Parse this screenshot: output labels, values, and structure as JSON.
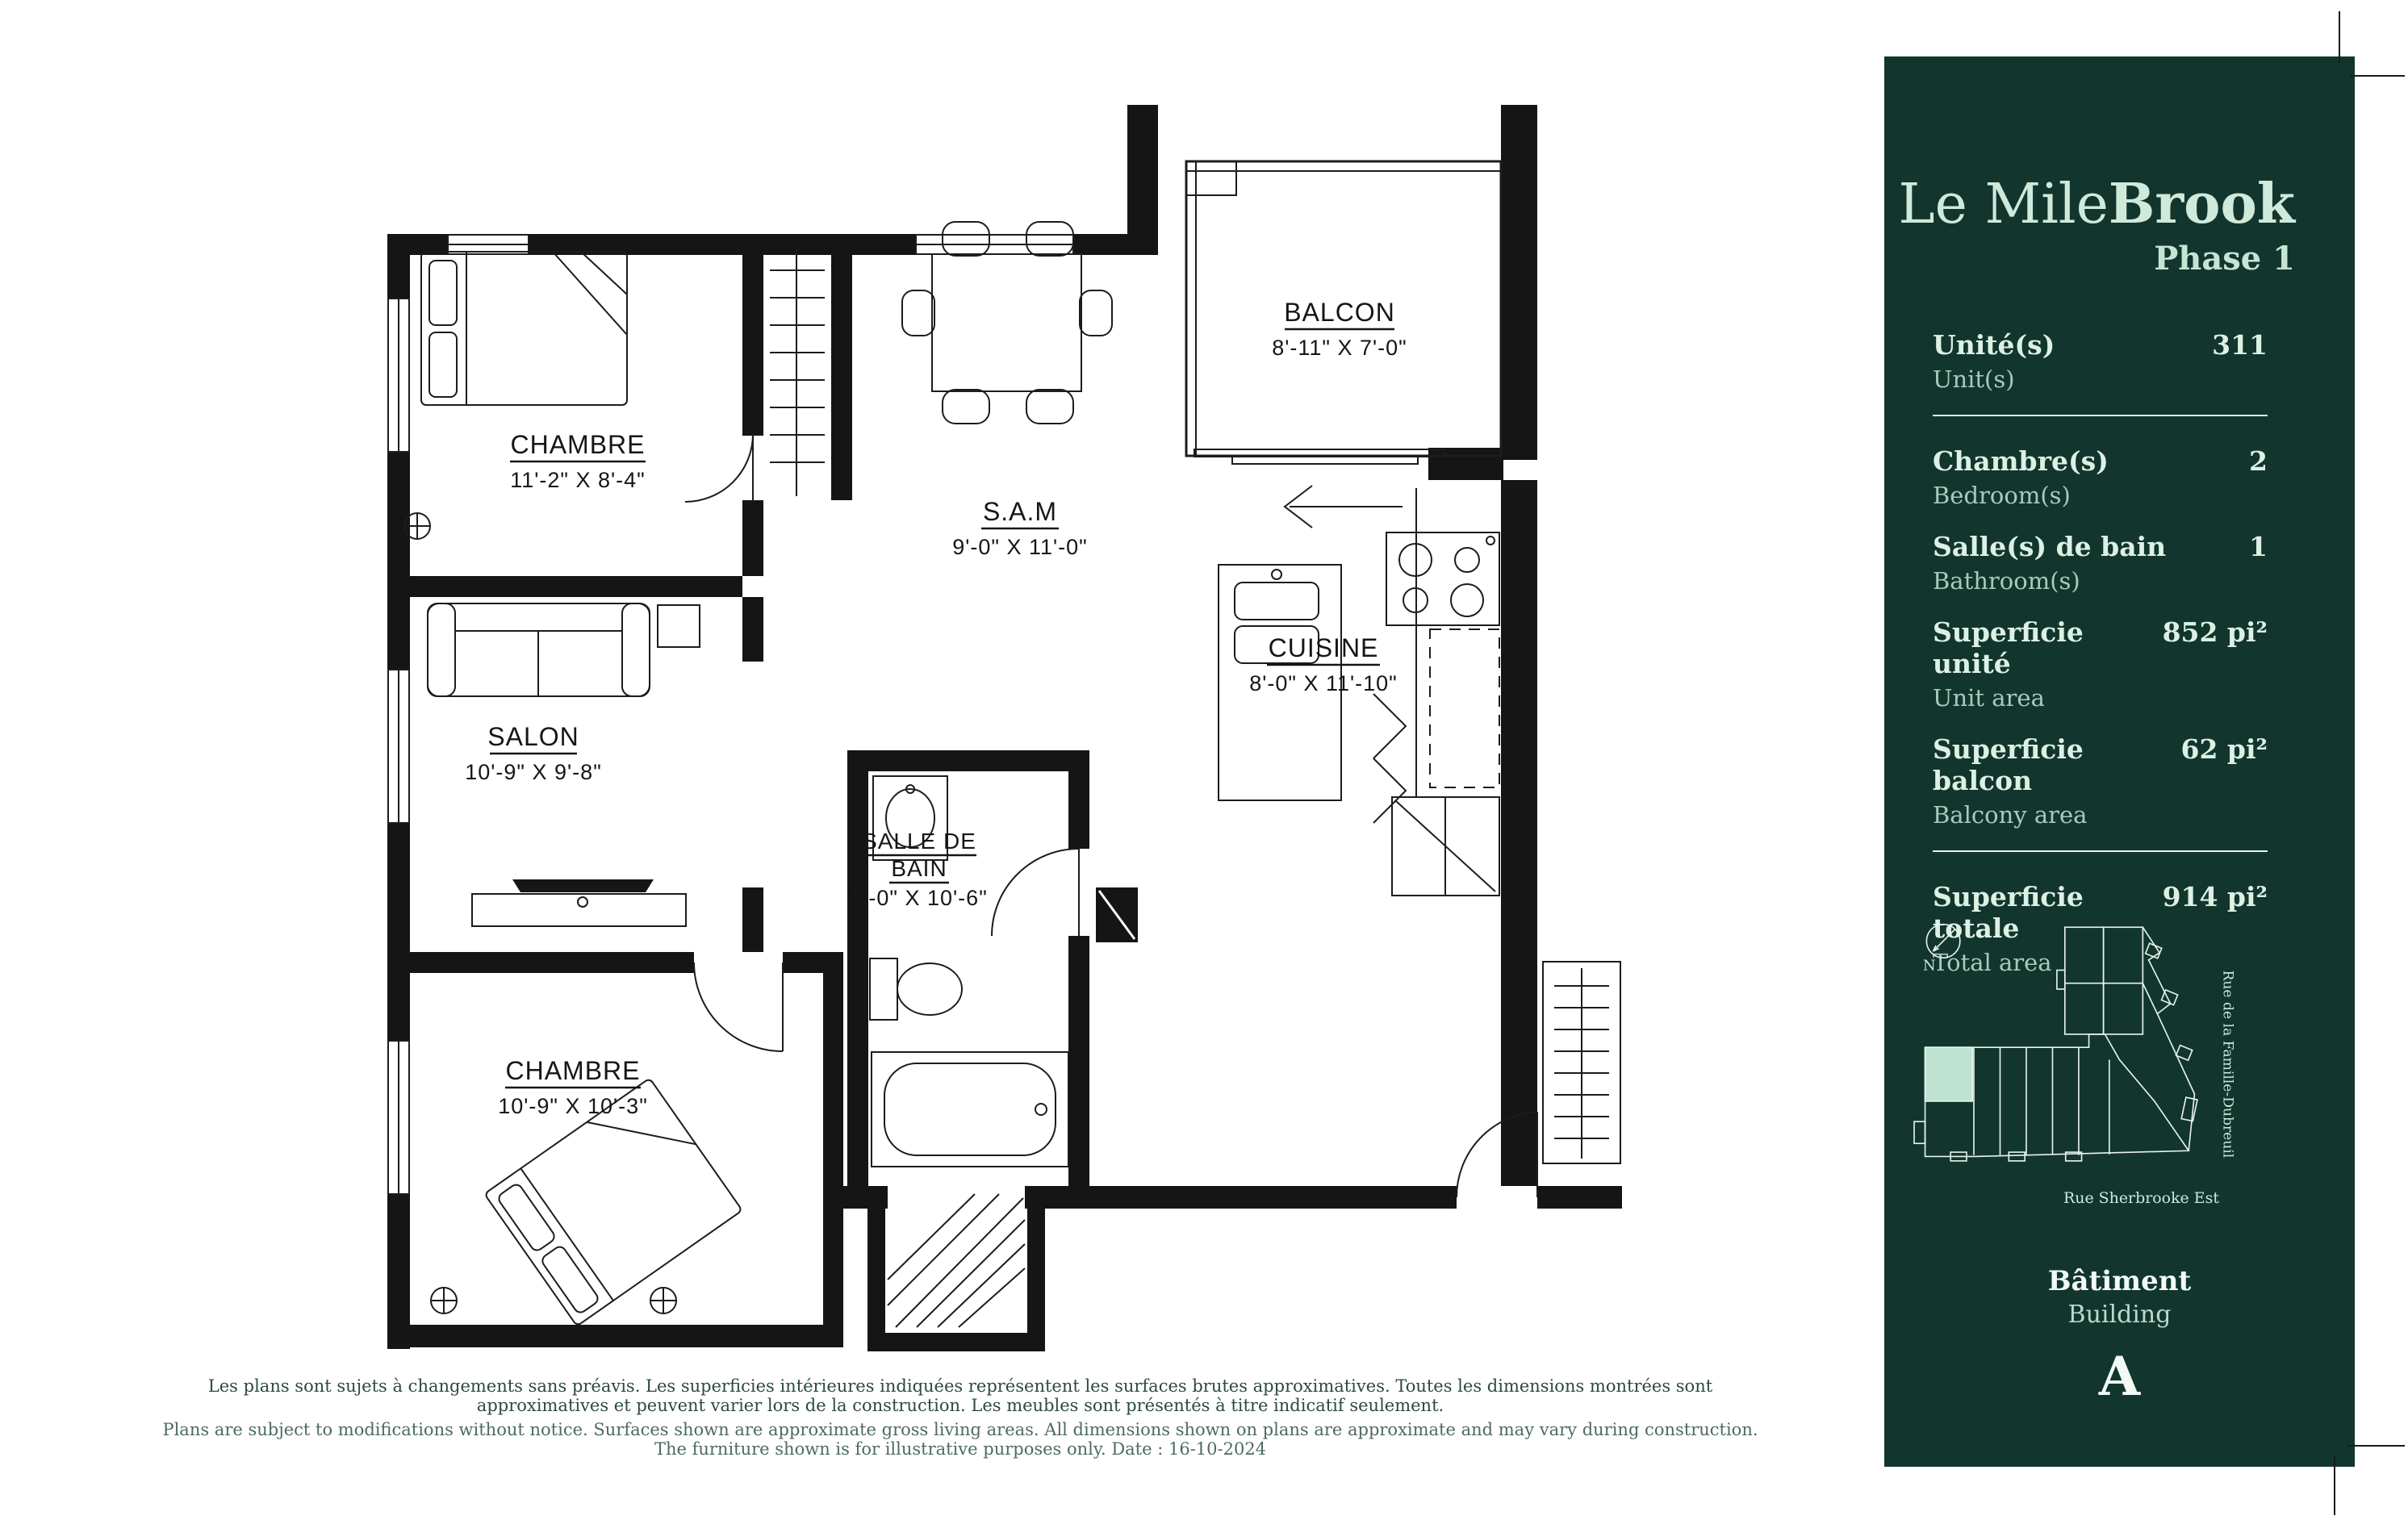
{
  "page": {
    "background": "#ffffff"
  },
  "sidebar": {
    "background": "#12362e",
    "text_color": "#cfe9da",
    "title": {
      "prefix": "Le Mile",
      "bold": "Brook",
      "phase": "Phase 1"
    },
    "stats": [
      {
        "label_fr": "Unité(s)",
        "label_en": "Unit(s)",
        "value": "311"
      },
      {
        "label_fr": "Chambre(s)",
        "label_en": "Bedroom(s)",
        "value": "2"
      },
      {
        "label_fr": "Salle(s) de bain",
        "label_en": "Bathroom(s)",
        "value": "1"
      },
      {
        "label_fr": "Superficie unité",
        "label_en": "Unit area",
        "value": "852 pi²"
      },
      {
        "label_fr": "Superficie balcon",
        "label_en": "Balcony area",
        "value": "62 pi²"
      },
      {
        "label_fr": "Superficie totale",
        "label_en": "Total area",
        "value": "914 pi²"
      }
    ],
    "map": {
      "compass_label": "N",
      "street_right": "Rue de la Famille-Dubreuil",
      "street_bottom": "Rue Sherbrooke Est",
      "highlight_color": "#bfe3d2",
      "line_color": "#e8f4ec"
    },
    "building": {
      "label_fr": "Bâtiment",
      "label_en": "Building",
      "value": "A"
    }
  },
  "plan": {
    "rooms": {
      "chambre1": {
        "name": "CHAMBRE",
        "dims": "11'-2\" X 8'-4\""
      },
      "sam": {
        "name": "S.A.M",
        "dims": "9'-0\" X 11'-0\""
      },
      "balcon": {
        "name": "BALCON",
        "dims": "8'-11\" X 7'-0\""
      },
      "cuisine": {
        "name": "CUISINE",
        "dims": "8'-0\" X 11'-10\""
      },
      "salon": {
        "name": "SALON",
        "dims": "10'-9\" X 9'-8\""
      },
      "salle_de_bain": {
        "name_line1": "SALLE DE",
        "name_line2": "BAIN",
        "dims": "5'-0\" X 10'-6\""
      },
      "chambre2": {
        "name": "CHAMBRE",
        "dims": "10'-9\" X 10'-3\""
      }
    }
  },
  "disclaimer": {
    "fr": "Les plans sont sujets à changements sans préavis. Les superficies intérieures indiquées représentent les surfaces brutes approximatives. Toutes les dimensions montrées sont approximatives et peuvent varier lors de la construction. Les meubles sont présentés à titre indicatif seulement.",
    "en": "Plans are subject to modifications without notice. Surfaces shown are approximate gross living areas. All dimensions shown on plans are approximate and may vary during construction. The furniture shown is for illustrative purposes only. Date : 16-10-2024"
  }
}
